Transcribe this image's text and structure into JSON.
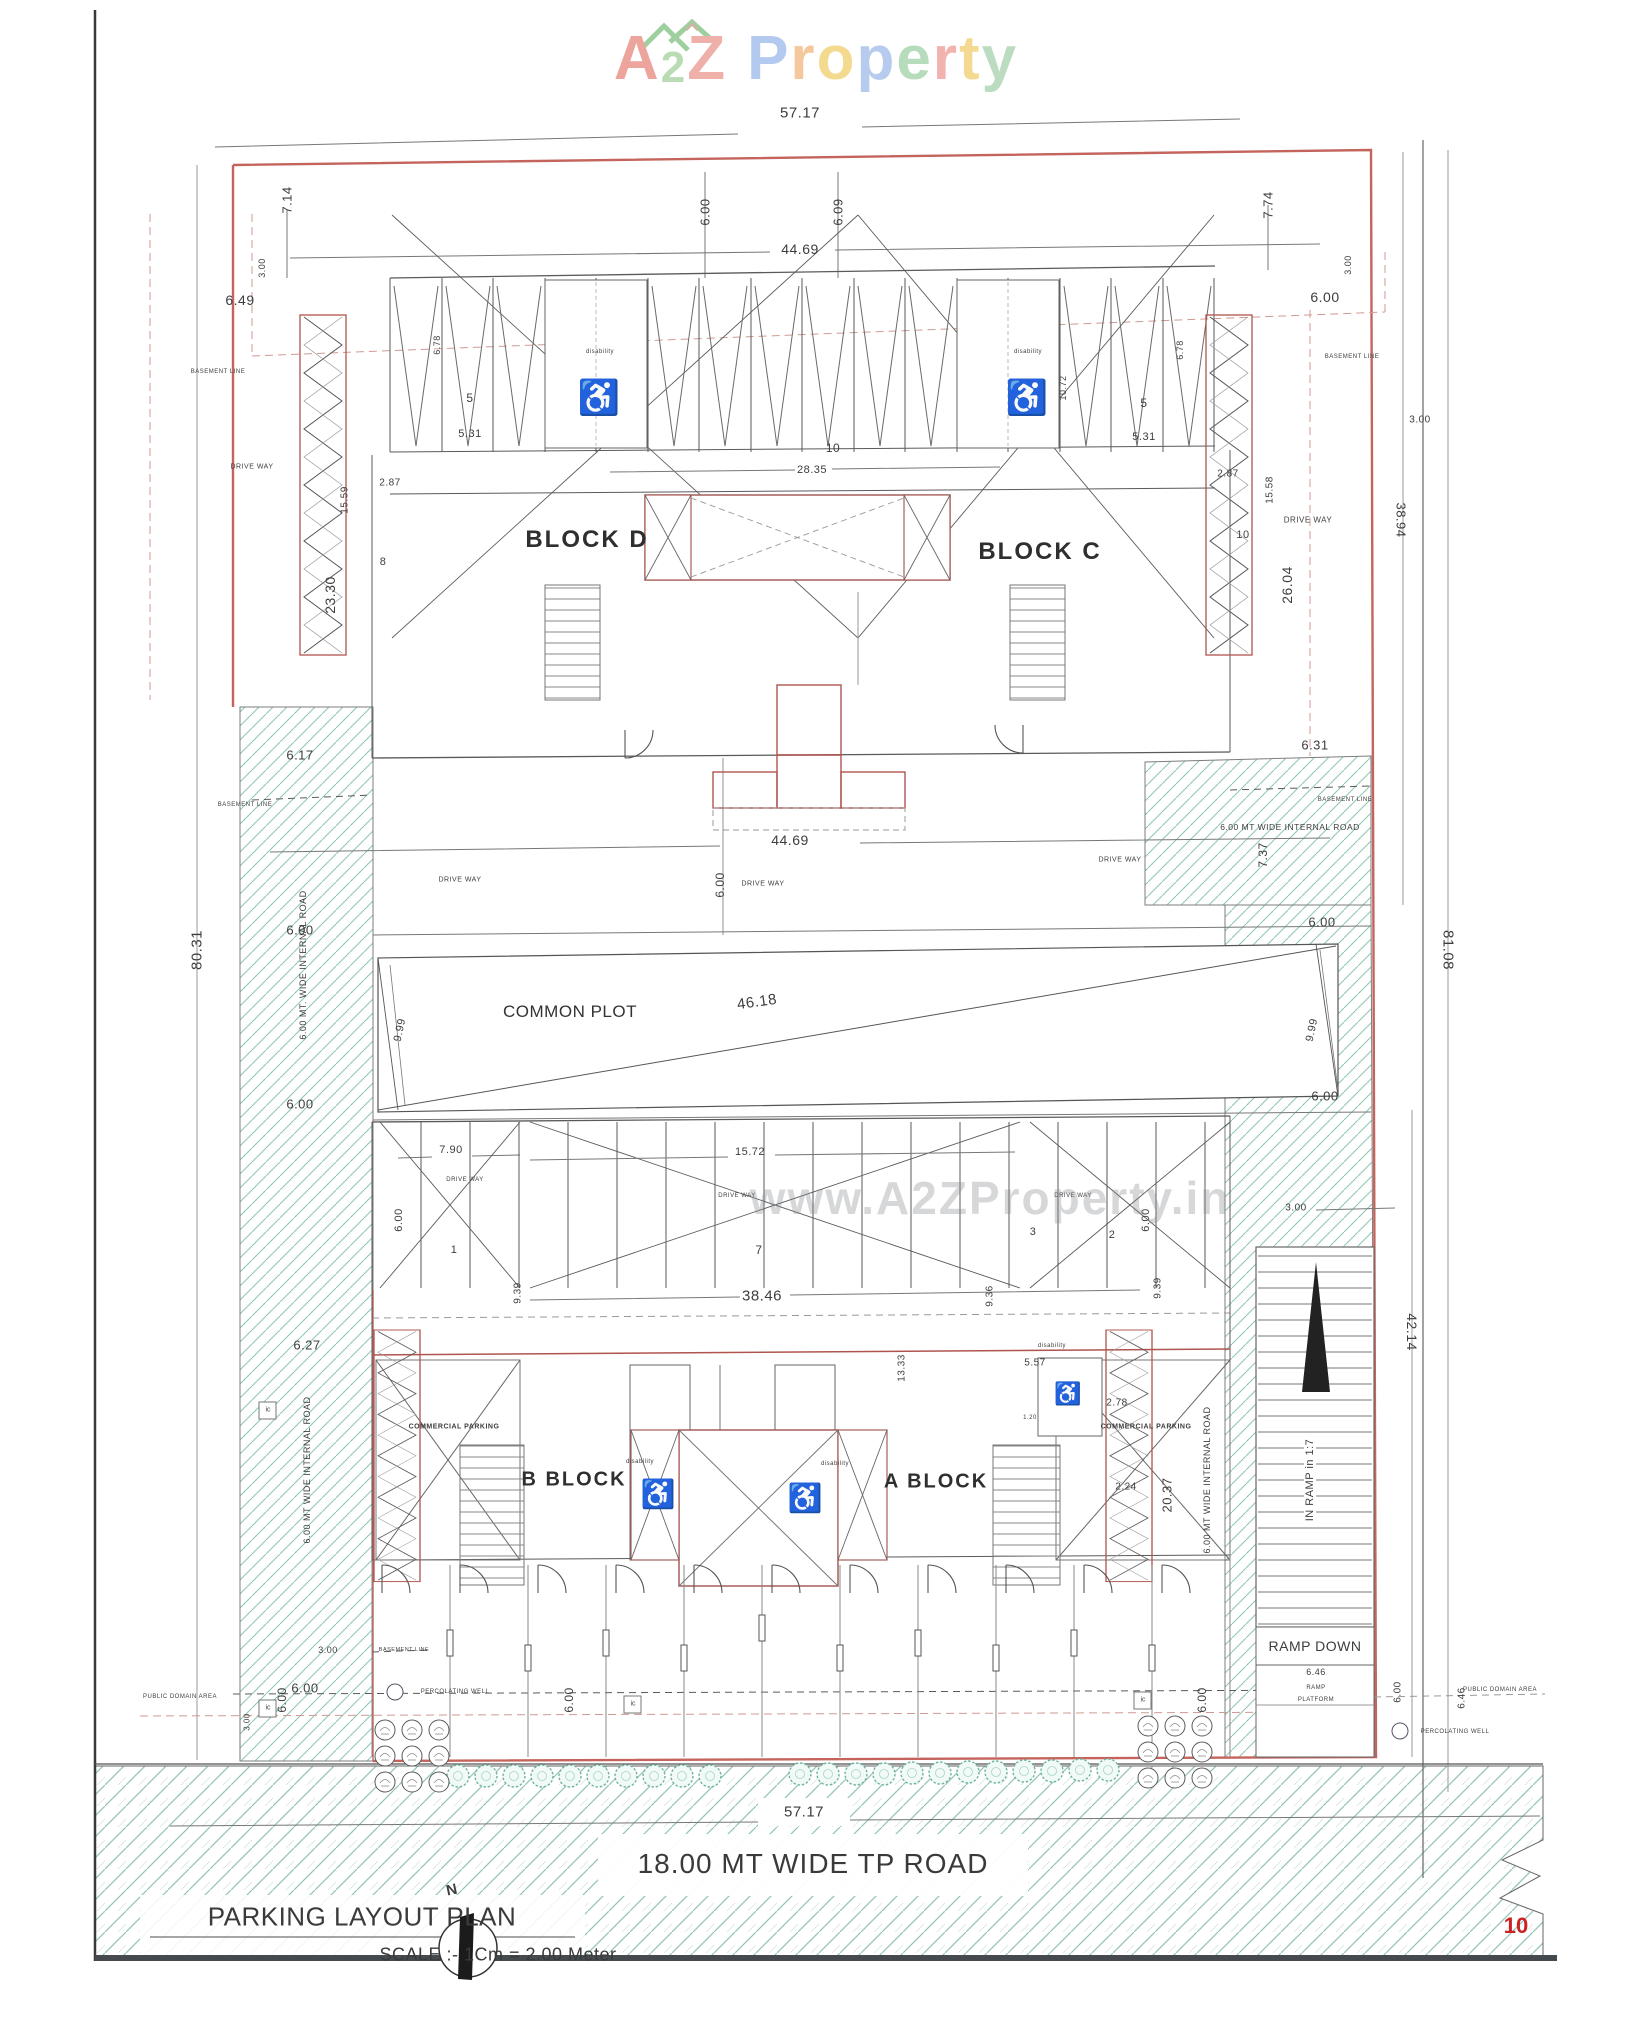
{
  "logo": {
    "letters": [
      {
        "ch": "A",
        "c": "#eda49c"
      },
      {
        "ch": "2",
        "c": "#b9dcb4"
      },
      {
        "ch": "Z",
        "c": "#efb0aa"
      },
      {
        "ch": "P",
        "c": "#b3c9f0"
      },
      {
        "ch": "r",
        "c": "#f4c79c"
      },
      {
        "ch": "o",
        "c": "#f4da8e"
      },
      {
        "ch": "p",
        "c": "#b7cbee"
      },
      {
        "ch": "e",
        "c": "#b6dcbc"
      },
      {
        "ch": "r",
        "c": "#f2b2ae"
      },
      {
        "ch": "t",
        "c": "#f4da90"
      },
      {
        "ch": "y",
        "c": "#bcdcc2"
      }
    ]
  },
  "page_number": "10",
  "watermark": "www.A2ZProperty.in",
  "title_block": {
    "title": "PARKING LAYOUT PLAN",
    "scale": "SCALE :- 1Cm = 2.00 Meter",
    "north": "N"
  },
  "road": {
    "label": "18.00 MT WIDE TP ROAD"
  },
  "blocks": {
    "d": "BLOCK D",
    "c": "BLOCK C",
    "b": "B BLOCK",
    "a": "A BLOCK"
  },
  "labels": {
    "drive_way": "DRIVE WAY",
    "basement_line": "BASEMENT LINE",
    "internal_road": "6.00 MT WIDE INTERNAL ROAD",
    "internal_road_dotted": "6.00 MT. WIDE INTERNAL ROAD",
    "common_plot": "COMMON PLOT",
    "commercial_parking": "COMMERCIAL PARKING",
    "disability": "disability",
    "public_domain": "PUBLIC DOMAIN AREA",
    "percolating_well": "PERCOLATING WELL",
    "ic": "ic",
    "ramp_down": "RAMP DOWN",
    "ramp": "RAMP",
    "platform": "PLATFORM",
    "in_ramp": "IN RAMP in 1:7"
  },
  "dims": {
    "d5717": "57.17",
    "d4469": "44.69",
    "d714": "7.14",
    "d600": "6.00",
    "d609": "6.09",
    "d774": "7.74",
    "d300": "3.00",
    "d649": "6.49",
    "d3894": "38.94",
    "d8031": "80.31",
    "d8108": "81.08",
    "d2330": "23.30",
    "d2604": "26.04",
    "d1559": "15.59",
    "d1558": "15.58",
    "d531": "5.31",
    "d287": "2.87",
    "d678": "6.78",
    "d1072": "10.72",
    "d2835": "28.35",
    "d617": "6.17",
    "d631": "6.31",
    "d737": "7.37",
    "d999": "9.99",
    "d4618": "46.18",
    "d790": "7.90",
    "d1572": "15.72",
    "d3846": "38.46",
    "d939": "9.39",
    "d936": "9.36",
    "d627": "6.27",
    "d1333": "13.33",
    "d557": "5.57",
    "d278": "2.78",
    "d224": "2.24",
    "d120": "1.20",
    "d2037": "20.37",
    "d4214": "42.14",
    "d646": "6.46"
  },
  "nums": {
    "n1": "1",
    "n2": "2",
    "n3": "3",
    "n5": "5",
    "n7": "7",
    "n8": "8",
    "n10": "10"
  },
  "icons": {
    "wheelchair": "♿"
  },
  "colors": {
    "boundary": "#c4645c",
    "hatch": "#8cc5b5",
    "page_number": "#cc2222",
    "line": "#5a5a5a"
  }
}
